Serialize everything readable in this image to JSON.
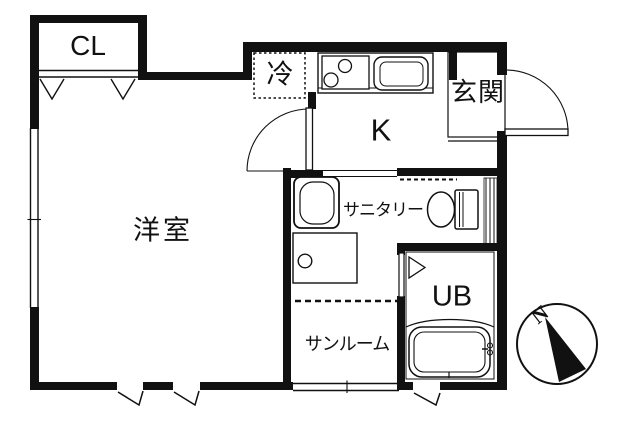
{
  "plan_type": "apartment-floor-plan",
  "rooms": {
    "closet": {
      "label": "CL"
    },
    "main_room": {
      "label": "洋室"
    },
    "kitchen": {
      "label": "K"
    },
    "entrance": {
      "label": "玄関"
    },
    "refrigerator_space": {
      "label": "冷"
    },
    "sanitary": {
      "label": "サニタリー"
    },
    "unit_bath": {
      "label": "UB"
    },
    "sunroom": {
      "label": "サンルーム"
    }
  },
  "compass": {
    "north_label": "N"
  },
  "colors": {
    "wall": "#111111",
    "background": "#ffffff",
    "line": "#111111"
  },
  "icons": [
    "stove-icon",
    "sink-icon",
    "washing-machine-icon",
    "toilet-icon",
    "washbasin-icon",
    "bathtub-icon",
    "door-swing-icon",
    "folding-door-icon",
    "window-icon",
    "vent-icon",
    "compass-icon"
  ]
}
